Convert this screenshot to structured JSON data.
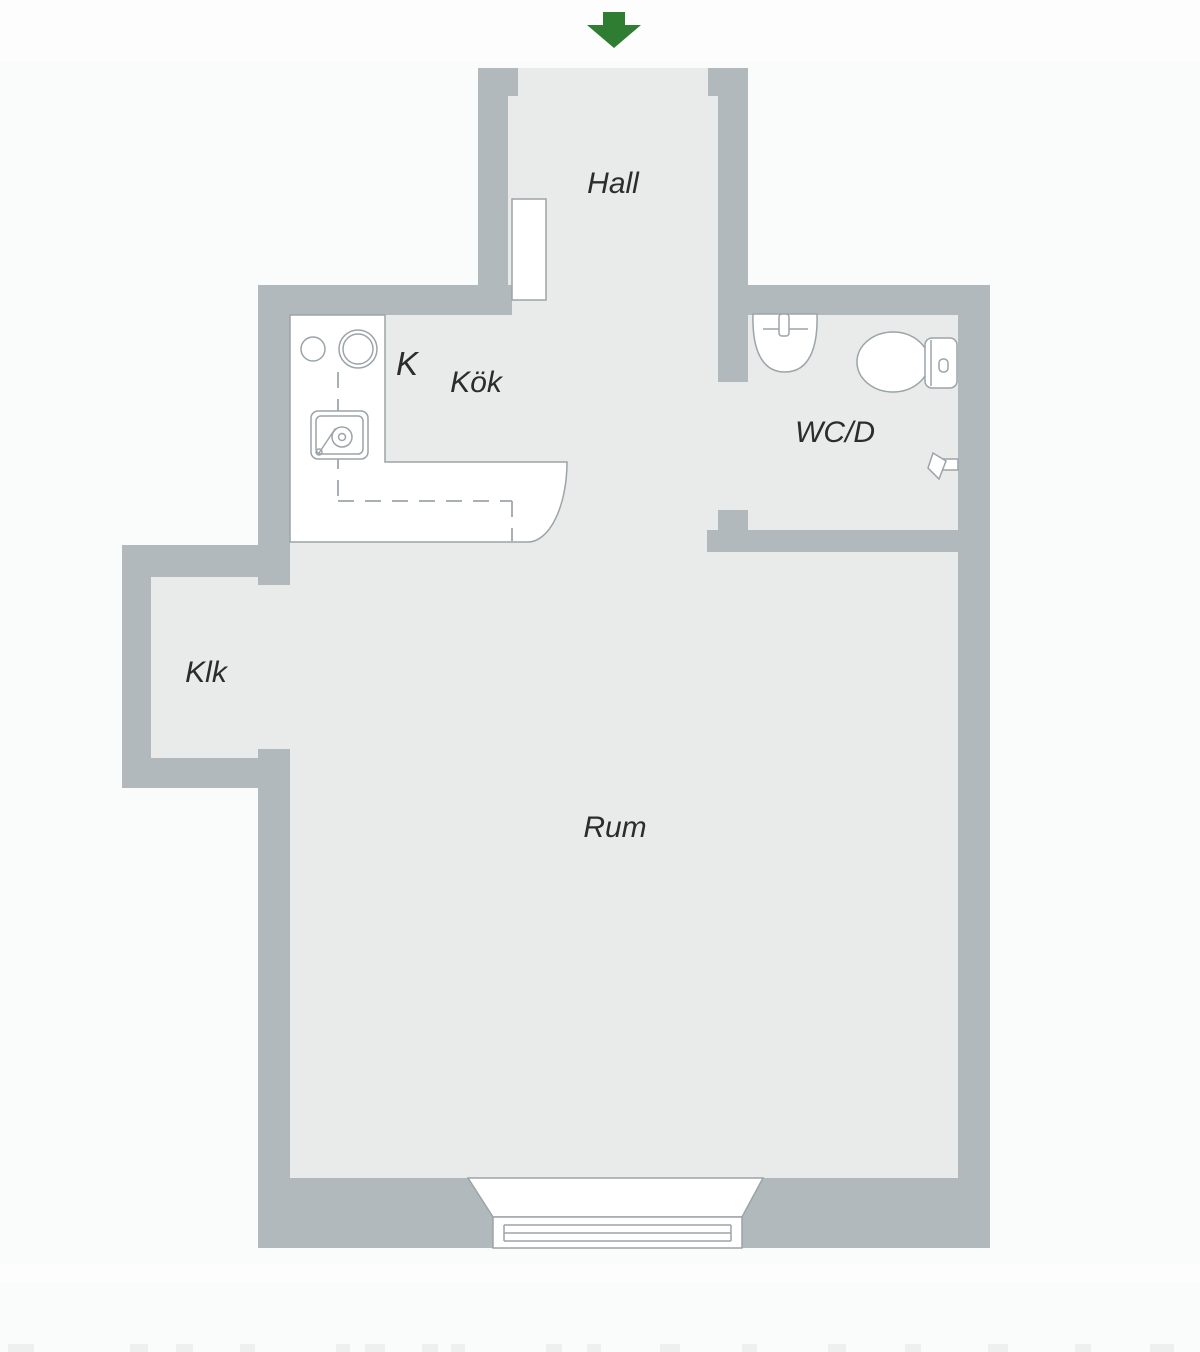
{
  "plan": {
    "type": "apartment-floor-plan",
    "colors": {
      "wall": "#b1b9bd",
      "floor": "#e9ebeb",
      "fixture_stroke": "#9ba4a8",
      "canvas": "#fafbfb",
      "text": "#2c2c2c",
      "arrow": "#2e7d32"
    },
    "entrance": {
      "name": "entrance-arrow",
      "direction": "down"
    },
    "rooms": {
      "hall": {
        "label": "Hall"
      },
      "kitchen": {
        "label": "Kök",
        "appliance_label": "K"
      },
      "wc": {
        "label": "WC/D"
      },
      "closet": {
        "label": "Klk"
      },
      "main_room": {
        "label": "Rum"
      }
    },
    "fixtures": [
      "kitchen-counter",
      "kitchen-hob-burners",
      "kitchen-sink",
      "hall-cabinet",
      "wc-washbasin",
      "wc-toilet",
      "wc-shower-mixer",
      "window"
    ]
  }
}
